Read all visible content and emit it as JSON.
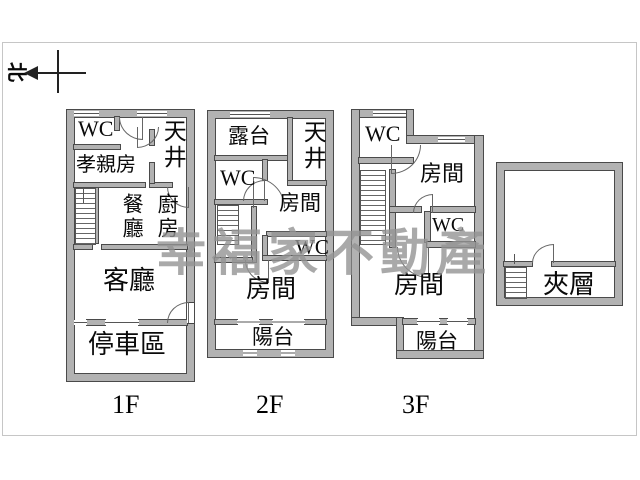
{
  "compass": {
    "north_label": "北"
  },
  "watermark": {
    "text": "幸福家不動產",
    "color": "#949494"
  },
  "floor1": {
    "label": "1F",
    "wc": "WC",
    "skylight": "天井",
    "parents_room": "孝親房",
    "dining": "餐廳",
    "kitchen": "廚房",
    "living": "客廳",
    "parking": "停車區"
  },
  "floor2": {
    "label": "2F",
    "terrace": "露台",
    "skylight": "天井",
    "wc_upper": "WC",
    "room_upper": "房間",
    "wc_lower": "WC",
    "room_lower": "房間",
    "balcony": "陽台"
  },
  "floor3": {
    "label": "3F",
    "wc_upper": "WC",
    "room_upper": "房間",
    "wc_mid": "WC",
    "room_lower": "房間",
    "balcony": "陽台"
  },
  "mezzanine": {
    "label": "夾層"
  },
  "wall_color": "#b2b2b2"
}
